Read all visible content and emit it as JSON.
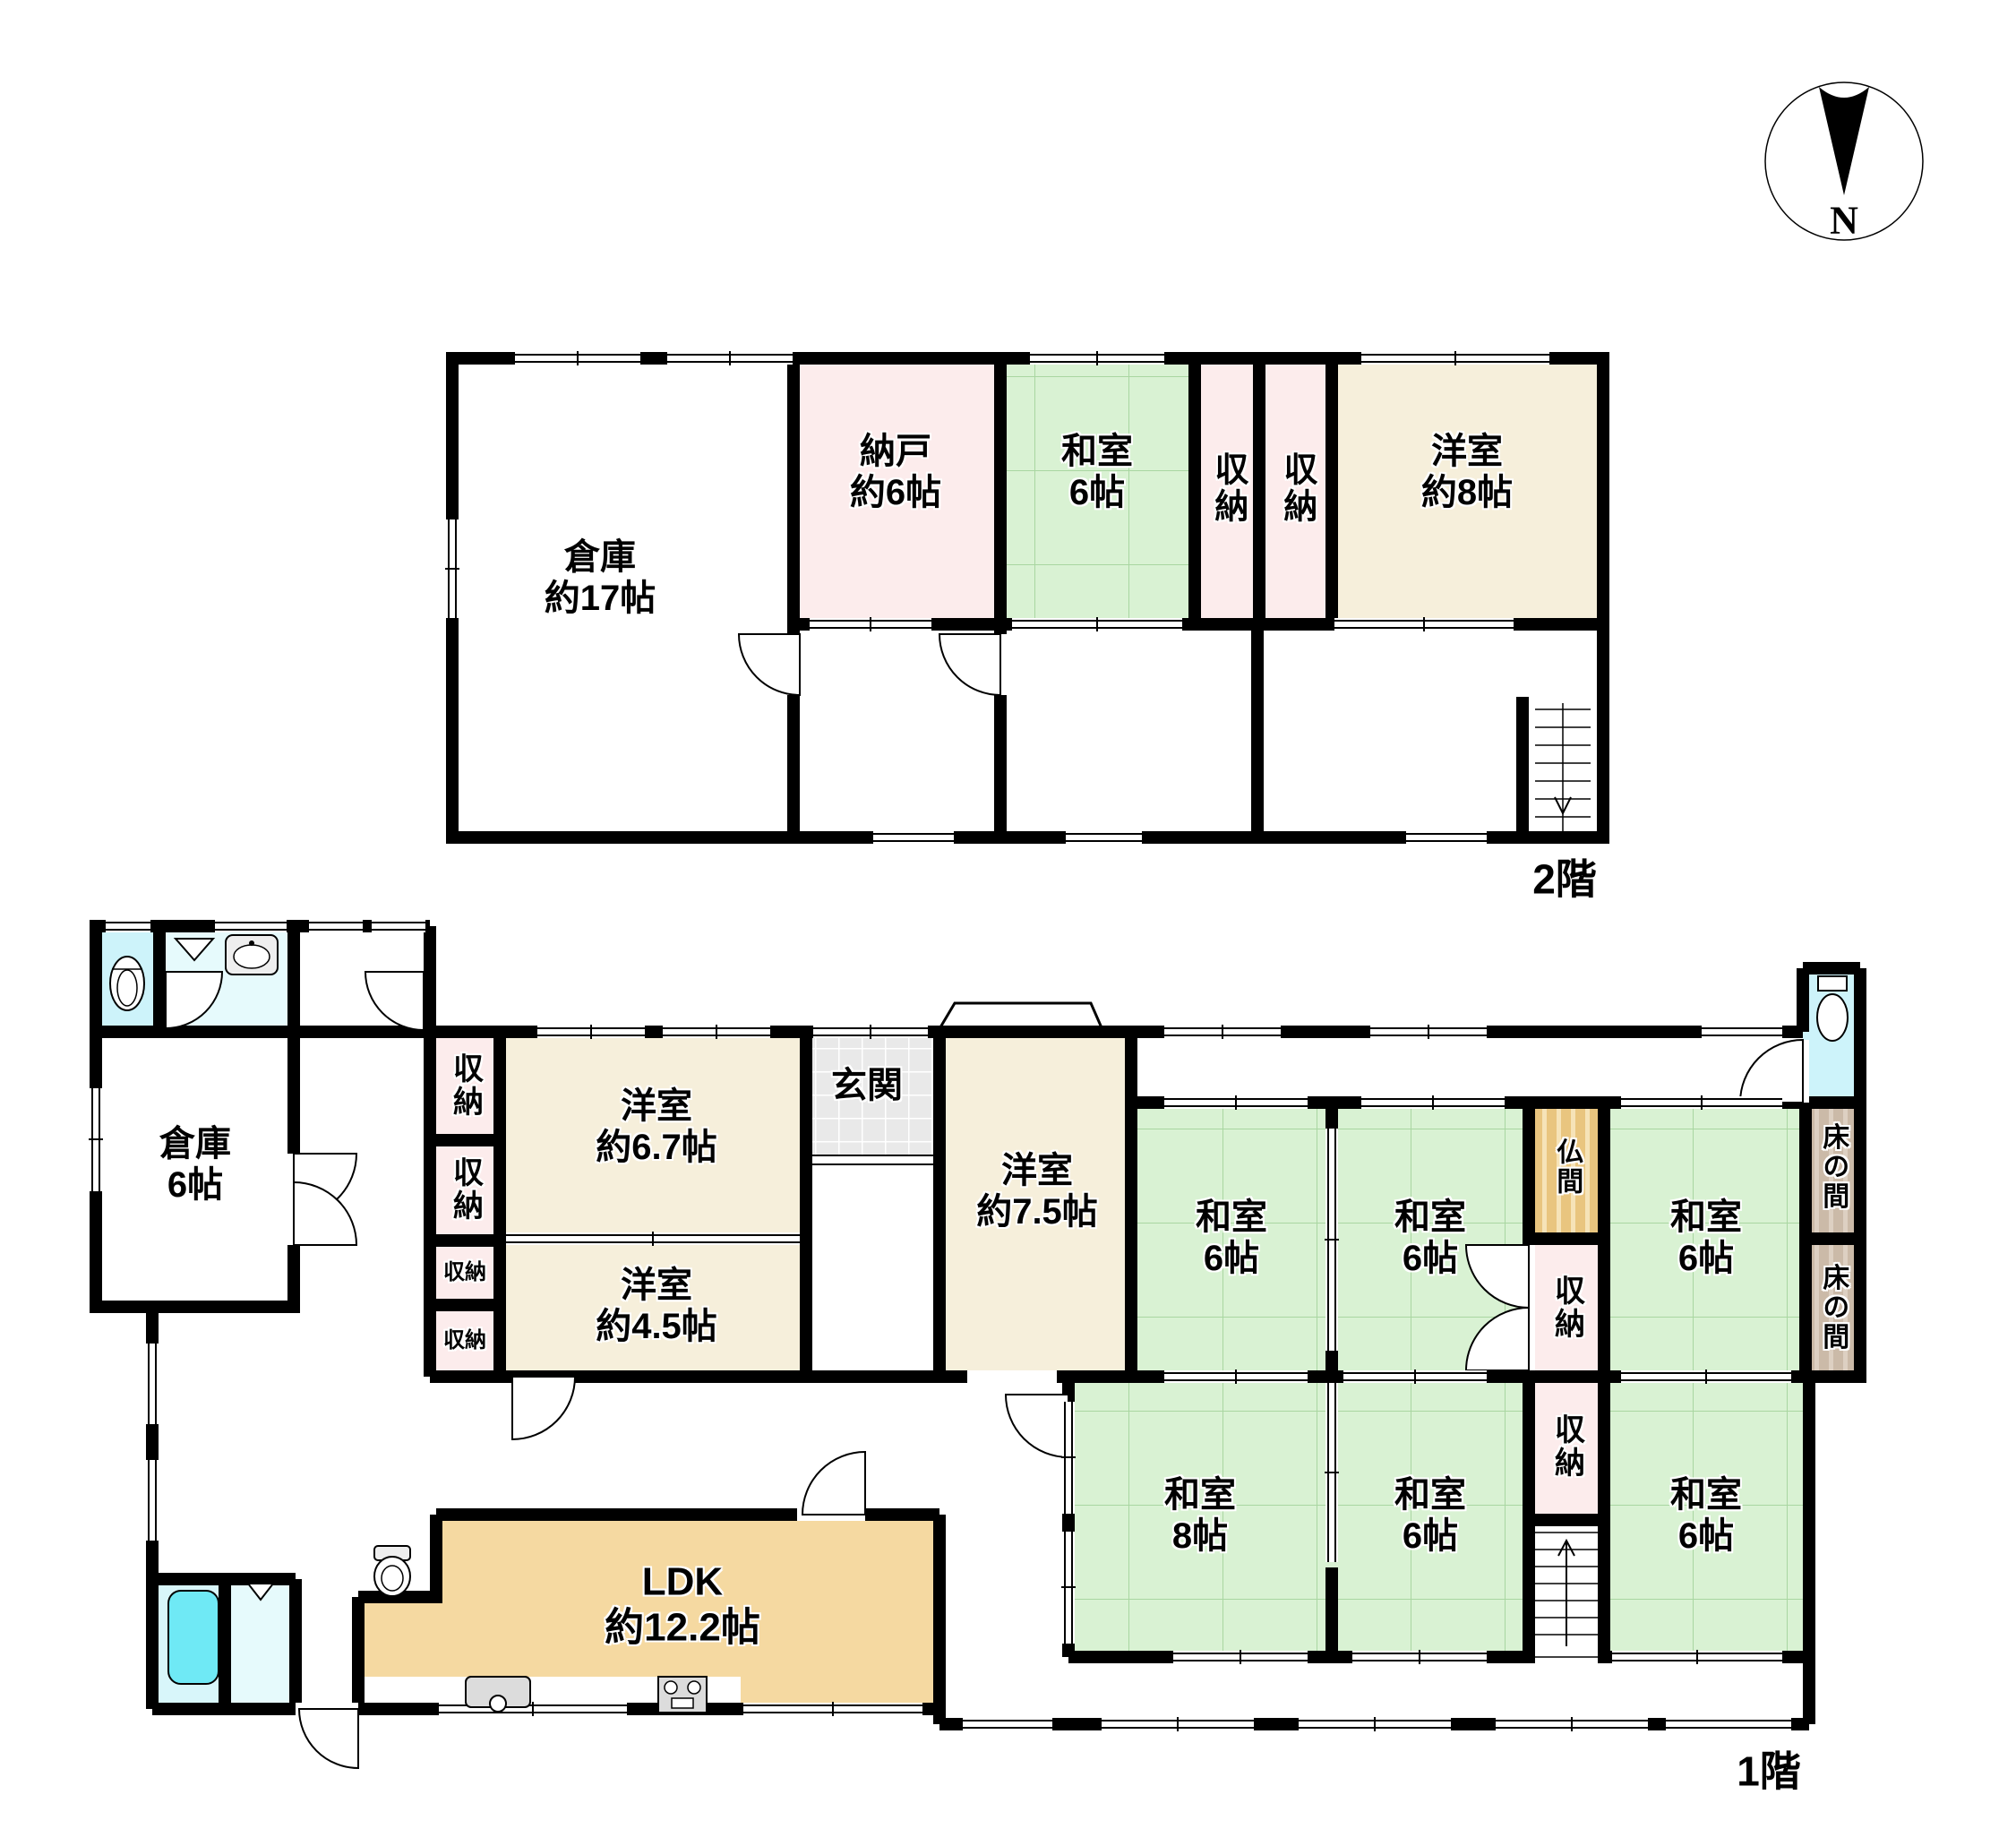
{
  "palette": {
    "wall": "#000000",
    "tatami_room": "#d9f2d3",
    "western_room": "#f6efdb",
    "closet": "#fcecec",
    "ldk": "#f5d9a1",
    "water_area": "#6fe9f5",
    "butsuma": "#e9c57f",
    "tokonoma": "#cbbaa8"
  },
  "compass": {
    "north_label": "N"
  },
  "f2": {
    "floor_label": "2階",
    "souko17": {
      "name": "倉庫",
      "area": "約17帖"
    },
    "nando6": {
      "name": "納戸",
      "area": "約6帖"
    },
    "washitsu6": {
      "name": "和室",
      "area": "6帖"
    },
    "shuno_a": {
      "name": "収納"
    },
    "shuno_b": {
      "name": "収納"
    },
    "yoshitsu8": {
      "name": "洋室",
      "area": "約8帖"
    }
  },
  "f1": {
    "floor_label": "1階",
    "souko6": {
      "name": "倉庫",
      "area": "6帖"
    },
    "shuno_1": {
      "name": "収納"
    },
    "shuno_2": {
      "name": "収納"
    },
    "shuno_3": {
      "name": "収納"
    },
    "shuno_4": {
      "name": "収納"
    },
    "yoshitsu67": {
      "name": "洋室",
      "area": "約6.7帖"
    },
    "yoshitsu45": {
      "name": "洋室",
      "area": "約4.5帖"
    },
    "genkan": {
      "name": "玄関"
    },
    "yoshitsu75": {
      "name": "洋室",
      "area": "約7.5帖"
    },
    "washitsu_a": {
      "name": "和室",
      "area": "6帖"
    },
    "washitsu_b": {
      "name": "和室",
      "area": "6帖"
    },
    "washitsu_c": {
      "name": "和室",
      "area": "6帖"
    },
    "butsuma": {
      "name": "仏間"
    },
    "shuno_5": {
      "name": "収納"
    },
    "tokonoma_a": {
      "name": "床の間"
    },
    "tokonoma_b": {
      "name": "床の間"
    },
    "washitsu_8": {
      "name": "和室",
      "area": "8帖"
    },
    "washitsu_d": {
      "name": "和室",
      "area": "6帖"
    },
    "washitsu_e": {
      "name": "和室",
      "area": "6帖"
    },
    "shuno_6": {
      "name": "収納"
    },
    "ldk": {
      "name": "LDK",
      "area": "約12.2帖"
    }
  }
}
